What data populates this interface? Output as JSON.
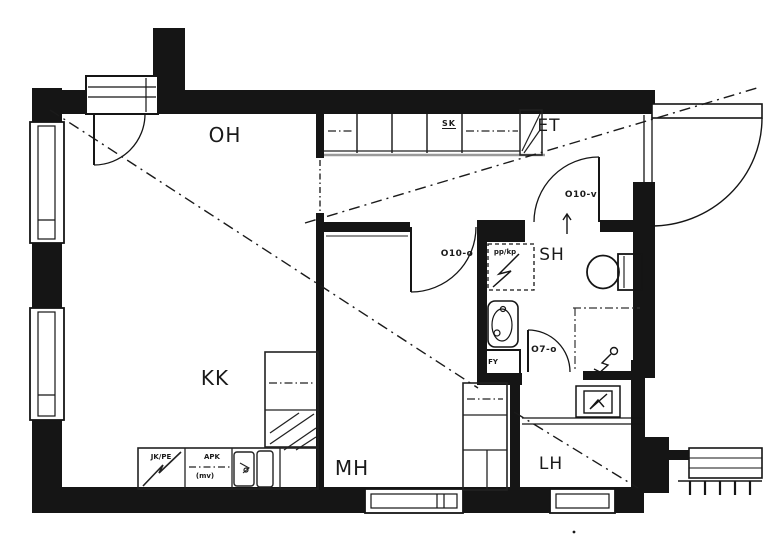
{
  "title": "Apartment floor plan",
  "rooms": {
    "oh": "OH",
    "kk": "KK",
    "mh": "MH",
    "et": "ET",
    "sh": "SH",
    "lh": "LH"
  },
  "doors": {
    "o10v": "O10-v",
    "o10o": "O10-o",
    "o7o": "O7-o"
  },
  "fixtures": {
    "sk": "SK",
    "pp_kp": "pp/kp",
    "fy": "FY",
    "jk_pe": "JK/PE",
    "apk": "APK",
    "mv": "(mv)"
  },
  "colors": {
    "wall": "#151515",
    "line": "#222222",
    "grey_line": "#9a9a9a",
    "background": "#ffffff"
  }
}
